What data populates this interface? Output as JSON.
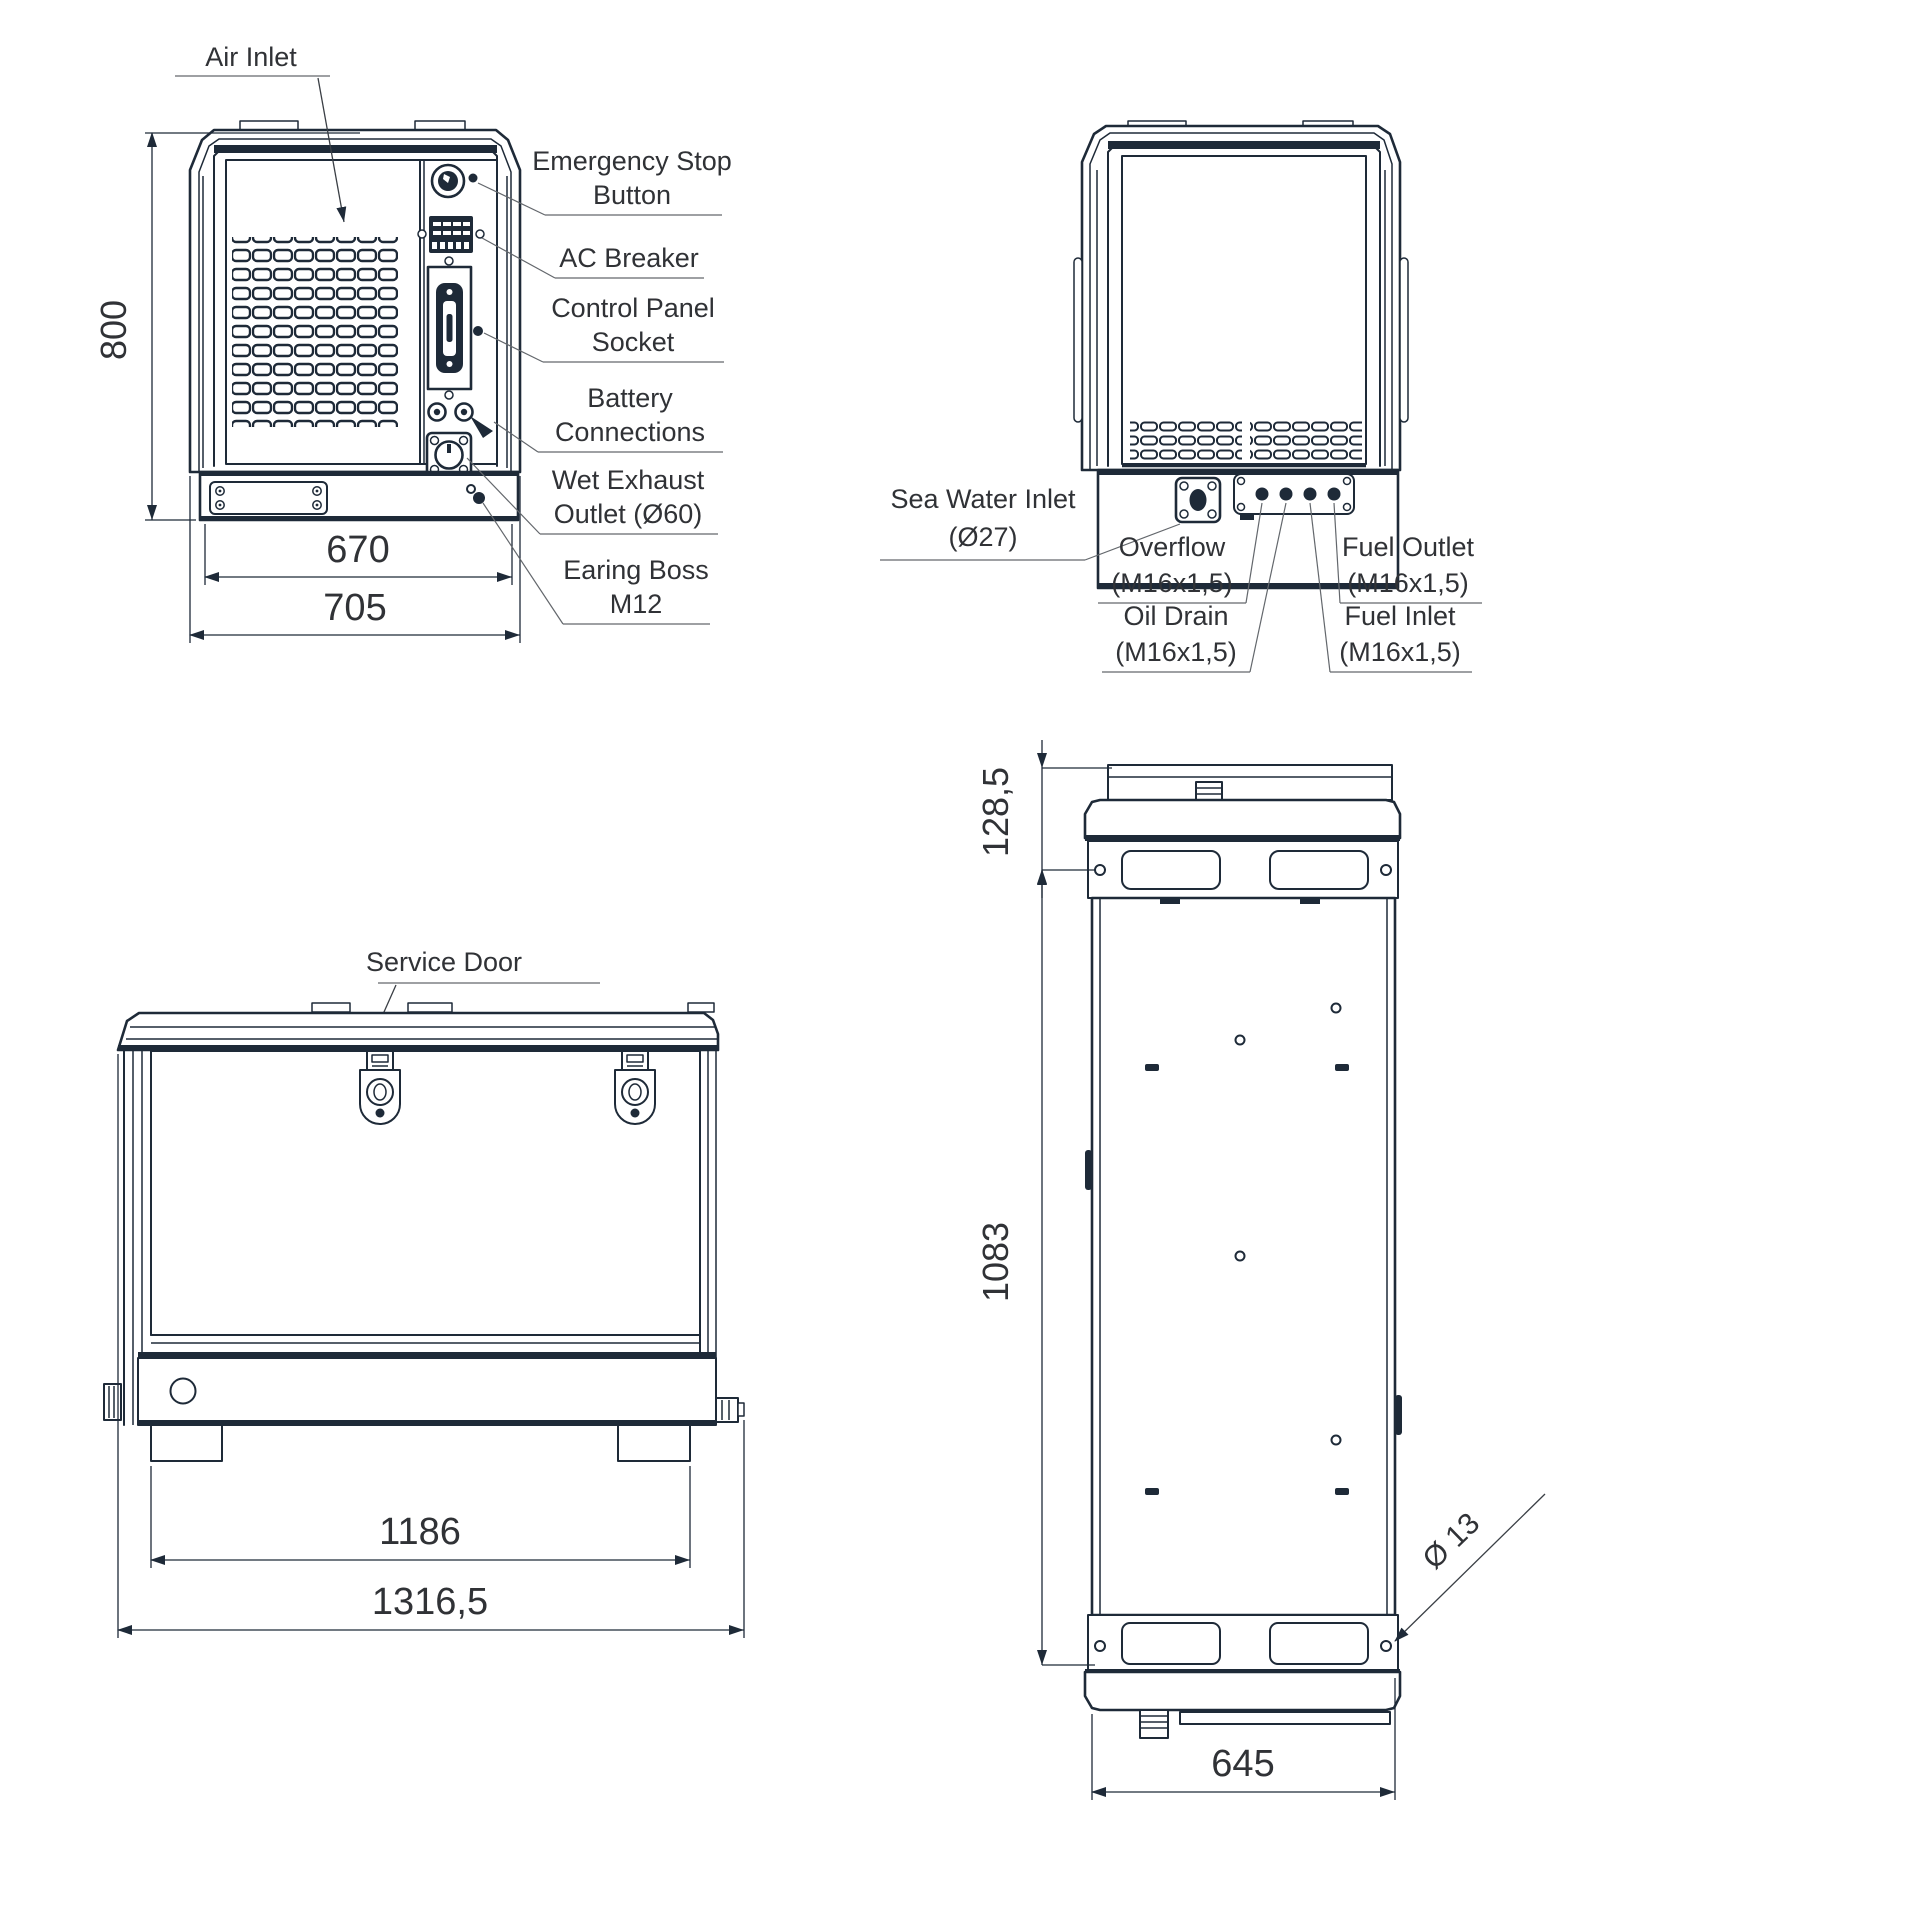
{
  "drawing": {
    "type": "technical-dimension-drawing",
    "subject": "marine generator enclosure - four orthographic views",
    "line_color": "#1e2a38",
    "text_color": "#303236",
    "leader_color": "#63676c",
    "background": "#ffffff"
  },
  "front_view": {
    "callouts": {
      "air_inlet": "Air Inlet",
      "emergency_stop": [
        "Emergency Stop",
        "Button"
      ],
      "ac_breaker": "AC Breaker",
      "control_panel_socket": [
        "Control Panel",
        "Socket"
      ],
      "battery_connections": [
        "Battery",
        "Connections"
      ],
      "wet_exhaust_outlet": [
        "Wet Exhaust",
        "Outlet (Ø60)"
      ],
      "earing_boss": [
        "Earing Boss",
        "M12"
      ]
    },
    "dimensions": {
      "height": "800",
      "inner_width": "670",
      "overall_width": "705"
    }
  },
  "back_view": {
    "callouts": {
      "sea_water_inlet": [
        "Sea Water Inlet",
        "(Ø27)"
      ],
      "overflow": [
        "Overflow",
        "(M16x1,5)"
      ],
      "oil_drain": [
        "Oil Drain",
        "(M16x1,5)"
      ],
      "fuel_outlet": [
        "Fuel Outlet",
        "(M16x1,5)"
      ],
      "fuel_inlet": [
        "Fuel Inlet",
        "(M16x1,5)"
      ]
    }
  },
  "side_view": {
    "callouts": {
      "service_door": "Service Door"
    },
    "dimensions": {
      "feet_width": "1186",
      "overall_length": "1316,5"
    }
  },
  "top_view": {
    "dimensions": {
      "rear_offset": "128,5",
      "body_length": "1083",
      "body_width": "645",
      "hole_diameter": "Ø 13"
    }
  }
}
